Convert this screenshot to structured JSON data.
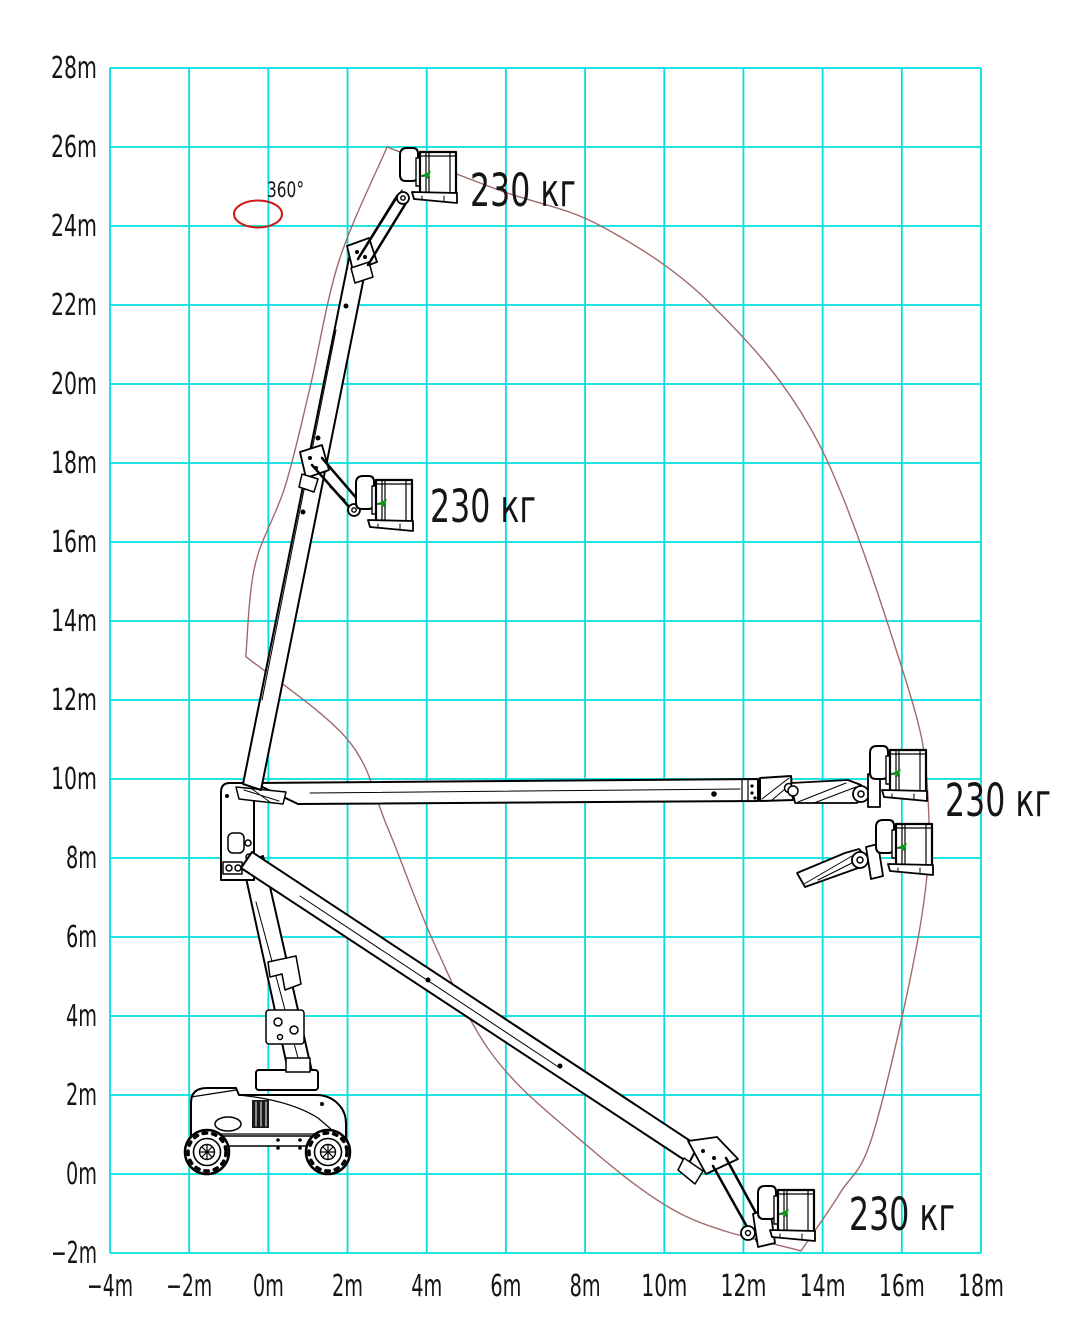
{
  "figure": {
    "background": "#ffffff",
    "grid_color": "#00dfdf",
    "envelope_color": "#a06a6a",
    "machine_color": "#000000",
    "accent_green": "#0a9a1a",
    "rotation_color": "#cc1818",
    "text_color": "#151515"
  },
  "chart_data": {
    "type": "area",
    "title": "",
    "units": "m",
    "grid": true,
    "x_axis": {
      "min": -4,
      "max": 18,
      "step": 2,
      "tick_labels": [
        "−4m",
        "−2m",
        "0m",
        "2m",
        "4m",
        "6m",
        "8m",
        "10m",
        "12m",
        "14m",
        "16m",
        "18m"
      ]
    },
    "y_axis": {
      "min": -2,
      "max": 28,
      "step": 2,
      "tick_labels": [
        "−2m",
        "0m",
        "2m",
        "4m",
        "6m",
        "8m",
        "10m",
        "12m",
        "14m",
        "16m",
        "18m",
        "20m",
        "22m",
        "24m",
        "26m",
        "28m"
      ]
    },
    "envelope_outer_m": [
      [
        3.0,
        26.0
      ],
      [
        5.85,
        24.9
      ],
      [
        8.4,
        24.0
      ],
      [
        11.2,
        22.0
      ],
      [
        13.9,
        18.5
      ],
      [
        16.1,
        12.5
      ],
      [
        16.65,
        9.7
      ],
      [
        16.5,
        6.5
      ],
      [
        15.3,
        1.1
      ],
      [
        14.44,
        -0.48
      ],
      [
        13.45,
        -1.95
      ]
    ],
    "envelope_inner_m": [
      [
        13.45,
        -1.95
      ],
      [
        10.4,
        -1.0
      ],
      [
        7.6,
        1.1
      ],
      [
        5.6,
        3.1
      ],
      [
        4.16,
        5.9
      ],
      [
        3.0,
        8.8
      ],
      [
        2.0,
        11.0
      ],
      [
        -0.57,
        13.1
      ]
    ],
    "envelope_left_m": [
      [
        -0.57,
        13.1
      ],
      [
        -0.34,
        15.4
      ],
      [
        0.42,
        17.4
      ],
      [
        1.05,
        19.9
      ],
      [
        1.78,
        23.1
      ],
      [
        3.0,
        26.0
      ]
    ],
    "load_labels": [
      {
        "text": "230 кг",
        "x_m": 5.09,
        "y_m": 24.5
      },
      {
        "text": "230 кг",
        "x_m": 4.08,
        "y_m": 16.5
      },
      {
        "text": "230 кг",
        "x_m": 17.09,
        "y_m": 9.06
      },
      {
        "text": "230 кг",
        "x_m": 14.64,
        "y_m": -1.39
      }
    ],
    "rotation": {
      "text": "360°",
      "x_m": -0.03,
      "y_m": 24.76,
      "ellipse_center_m": [
        -0.26,
        24.32
      ]
    },
    "machine_positions": [
      "boom raised with jib up, platform at ~25.5m height",
      "boom raised mid-telescope, platform at ~16.5m height",
      "boom horizontal jib up, platform at ~9.7m height and ~15.5m outreach",
      "boom horizontal jib level, platform at ~8m height",
      "boom lowered, platform at ~-1m below grade at ~13m outreach",
      "chassis with turret at origin"
    ]
  }
}
